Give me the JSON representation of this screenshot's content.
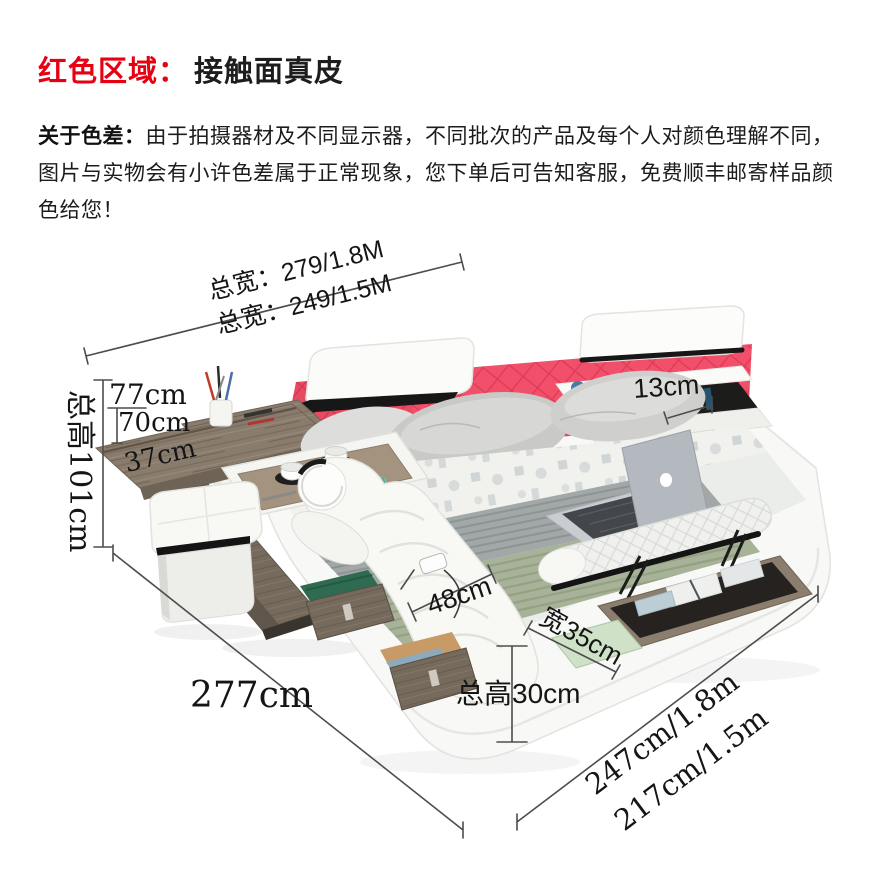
{
  "header": {
    "highlight_label": "红色区域：",
    "highlight_text": "接触面真皮",
    "highlight_color": "#e60012"
  },
  "disclaimer": {
    "bold_label": "关于色差：",
    "text": "由于拍摄器材及不同显示器，不同批次的产品及每个人对颜色理解不同，图片与实物会有小许色差属于正常现象，您下单后可告知客服，免费顺丰邮寄样品颜色给您！"
  },
  "diagram": {
    "dims": {
      "overall_width_queen": "总宽：279/1.8M",
      "overall_width_full": "总宽：249/1.5M",
      "tray_height": "77cm",
      "desk_height": "70cm",
      "desk_depth": "37cm",
      "overall_height": "总高101cm",
      "shelf_depth": "13cm",
      "chaise_width": "48cm",
      "bench_width": "宽35cm",
      "base_height": "总高30cm",
      "overall_depth": "277cm",
      "bed_length_queen": "247cm/1.8m",
      "bed_length_full": "217cm/1.5m"
    },
    "colors": {
      "accent_red_text": "#e60012",
      "headboard_pink": "#f2506a",
      "wood": "#8a7c6d",
      "blanket_gray": "#a2a8a7",
      "blanket_sage": "#a7b298",
      "dimension_line": "#4d4d4d"
    }
  }
}
